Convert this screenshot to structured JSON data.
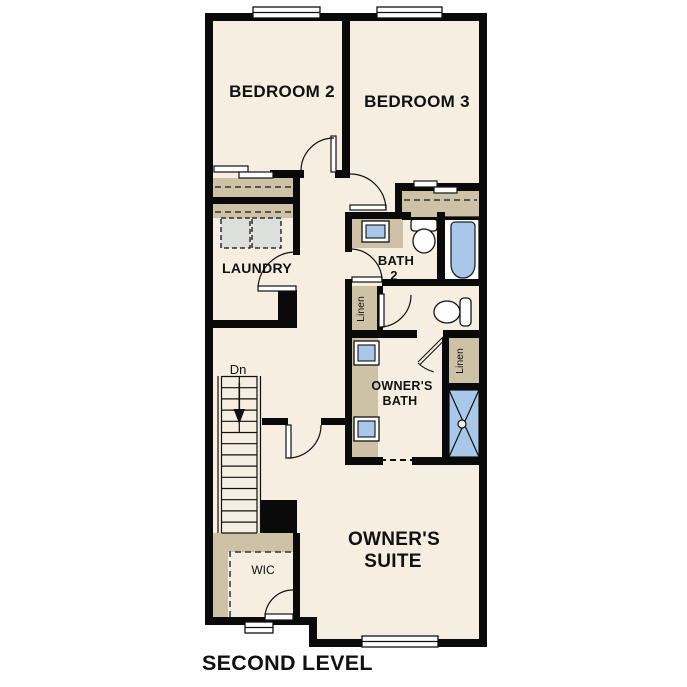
{
  "floor_plan": {
    "caption": "SECOND LEVEL",
    "rooms": {
      "bedroom2": {
        "label": "BEDROOM 2"
      },
      "bedroom3": {
        "label": "BEDROOM 3"
      },
      "laundry": {
        "label": "LAUNDRY"
      },
      "bath2": {
        "label_line1": "BATH",
        "label_line2": "2"
      },
      "owners_bath": {
        "label_line1": "OWNER'S",
        "label_line2": "BATH"
      },
      "owners_suite": {
        "label_line1": "OWNER'S",
        "label_line2": "SUITE"
      },
      "wic": {
        "label": "WIC"
      },
      "linen_upper": {
        "label": "Linen"
      },
      "linen_lower": {
        "label": "Linen"
      },
      "stairs": {
        "direction_label": "Dn"
      }
    },
    "fixtures": {
      "laundry_appliances": "washer-dryer-pair",
      "bath2": [
        "vanity-sink",
        "toilet",
        "bathtub"
      ],
      "water_closet": [
        "toilet"
      ],
      "owners_bath": [
        "vanity-sink-1",
        "vanity-sink-2",
        "shower"
      ],
      "closets": [
        "bedroom2-closet",
        "bedroom3-closet",
        "linen-upper",
        "linen-lower",
        "walk-in-closet"
      ]
    },
    "colors": {
      "wall": "#0a0a0a",
      "floor": "#f6eee0",
      "casework_tan": "#cdc2a6",
      "appliance_gray": "#dcdfdb",
      "fixture_blue": "#a9c7e8",
      "background": "#ffffff"
    }
  }
}
